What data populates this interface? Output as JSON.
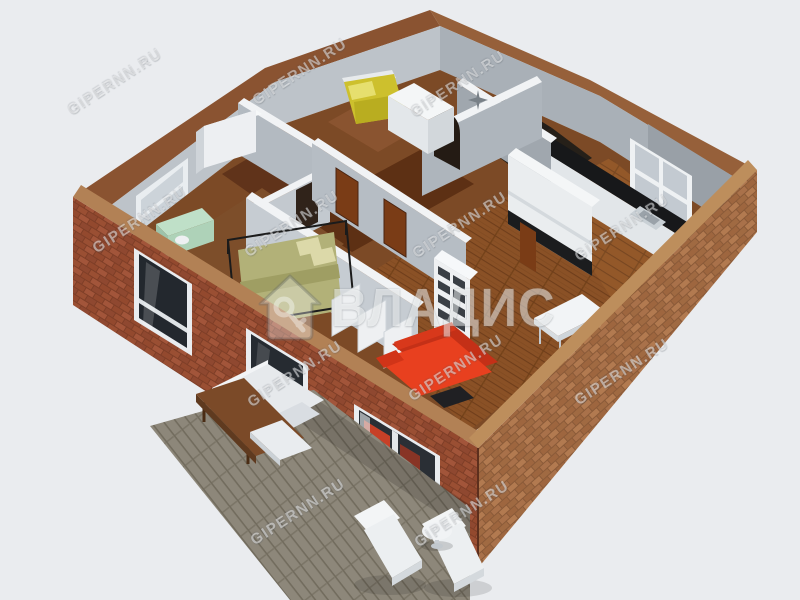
{
  "watermarks": {
    "tile_text": "GIPERNN.RU",
    "logo_text": "ВЛАДИС"
  },
  "palette": {
    "background": "#eaecef",
    "brick_left_wall": "#9a4f33",
    "brick_right_wall": "#a8714a",
    "brick_top_band_front": "#b28155",
    "brick_top_band_back": "#8a5331",
    "interior_wall_grey": "#b6bdc4",
    "wall_top_white": "#f1f3f5",
    "wood_floor_living": "#8a5126",
    "wood_floor_kitchen": "#935829",
    "hall_floor_dark": "#5d3014",
    "bathroom_floor_black": "#221d19",
    "deck_grey_wood": "#8d877a",
    "sofa_red": "#e8401f",
    "single_bed_yellow": "#cdc02d",
    "double_bed_olive": "#b2b178",
    "desk_mint": "#bfe0c8",
    "kitchen_counter_black": "#17181a",
    "white_furniture": "#eef0f2",
    "watermark_white": "rgba(255,255,255,0.48)"
  }
}
